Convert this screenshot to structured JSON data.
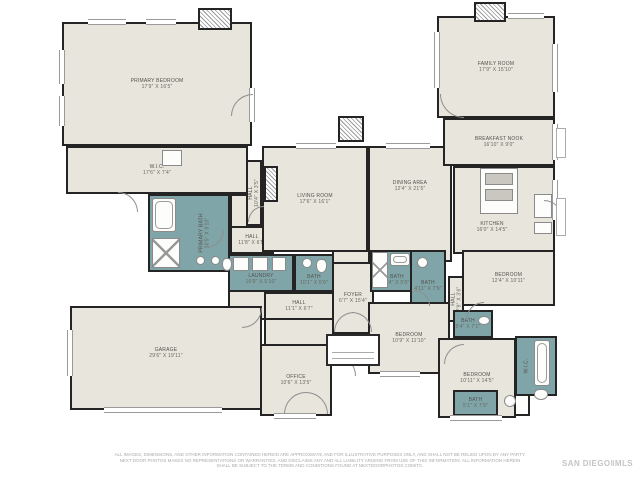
{
  "palette": {
    "floor_color": "#e7e5dc",
    "bath_color": "#7fa5a8",
    "wall_color": "#242424",
    "label_color": "#55524c"
  },
  "rooms": [
    {
      "name": "PRIMARY BEDROOM",
      "dim": "17'9\" X 16'5\""
    },
    {
      "name": "W.I.C.",
      "dim": "17'6\" X 7'4\""
    },
    {
      "name": "PRIMARY BATH",
      "dim": "16'5\" X 9'10\""
    },
    {
      "name": "HALL",
      "dim": "11'8\" X 6'5\""
    },
    {
      "name": "LAUNDRY",
      "dim": "10'9\" X 5'10\""
    },
    {
      "name": "BATH",
      "dim": "10'1\" X 5'0\""
    },
    {
      "name": "HALL",
      "dim": "11'1\" X 6'7\""
    },
    {
      "name": "FOYER",
      "dim": "6'7\" X 15'4\""
    },
    {
      "name": "LIVING ROOM",
      "dim": "17'6\" X 16'1\""
    },
    {
      "name": "DINING AREA",
      "dim": "12'4\" X 21'5\""
    },
    {
      "name": "FAMILY ROOM",
      "dim": "17'9\" X 15'10\""
    },
    {
      "name": "BREAKFAST NOOK",
      "dim": "16'10\" X 9'0\""
    },
    {
      "name": "KITCHEN",
      "dim": "16'0\" X 14'5\""
    },
    {
      "name": "HALL",
      "dim": "10'4\" X 3'5\""
    },
    {
      "name": "HALL",
      "dim": "7'9\" X 3'6\""
    },
    {
      "name": "BEDROOM",
      "dim": "12'4\" X 10'11\""
    },
    {
      "name": "BATH",
      "dim": "7'4\" X 5'0\""
    },
    {
      "name": "BATH",
      "dim": "4'11\" X 7'9\""
    },
    {
      "name": "BEDROOM",
      "dim": "10'9\" X 11'10\""
    },
    {
      "name": "BEDROOM",
      "dim": "10'11\" X 14'5\""
    },
    {
      "name": "BATH",
      "dim": "5'4\" X 7'1\""
    },
    {
      "name": "W.I.C."
    },
    {
      "name": "OFFICE",
      "dim": "10'6\" X 13'5\""
    },
    {
      "name": "GARAGE",
      "dim": "29'6\" X 19'11\""
    },
    {
      "name": "BATH",
      "dim": "5'1\" X 7'9\""
    }
  ],
  "footer": {
    "disclaimer_line1": "ALL IMAGES, DIMENSIONS, AND OTHER INFORMATION CONTAINED HEREIN ARE APPROXIMATE AND FOR ILLUSTRATIVE PURPOSES ONLY, AND SHALL NOT BE RELIED UPON BY ANY PARTY.",
    "disclaimer_line2": "NEXT DOOR PHOTOS MAKES NO REPRESENTATIONS OR WARRANTIES, AND DISCLAIMS ANY AND ALL LIABILITY ARISING FROM USE OF THIS INFORMATION. ALL INFORMATION HEREIN",
    "disclaimer_line3": "SHALL BE SUBJECT TO THE TERMS AND CONDITIONS FOUND AT NEXTDOORPHOTOS.COM/TC.",
    "logo": "SAN DIEGO‖MLS"
  }
}
